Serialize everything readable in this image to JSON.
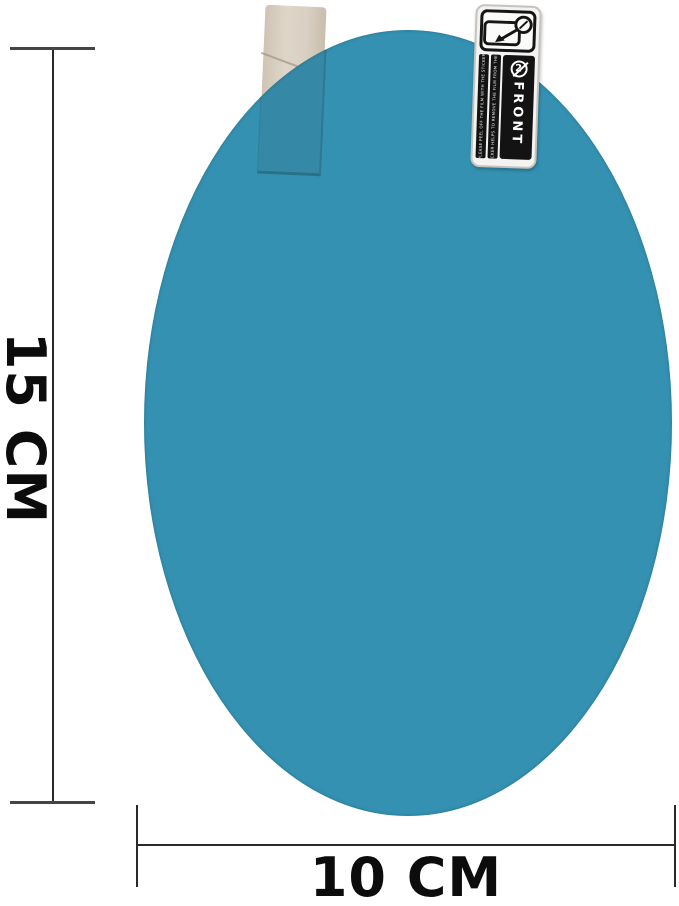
{
  "film": {
    "color": "#3591b1",
    "tab_color": "#d7ccbe"
  },
  "sticker_label": {
    "icon": "peel-arrow-icon",
    "number": "2",
    "front_text": "FRONT",
    "small_print_line1": "PLEASE PEEL OFF THE FILM WITH THE STICKER",
    "small_print_line2": "THIS STICKER HELPS TO REMOVE THE FILM FROM THE MIRROR"
  },
  "dimensions": {
    "height_label": "15 CM",
    "width_label": "10 CM"
  },
  "colors": {
    "dimension_line": "#2a2a2a",
    "text": "#0c0c0c",
    "sticker_black": "#131313"
  }
}
